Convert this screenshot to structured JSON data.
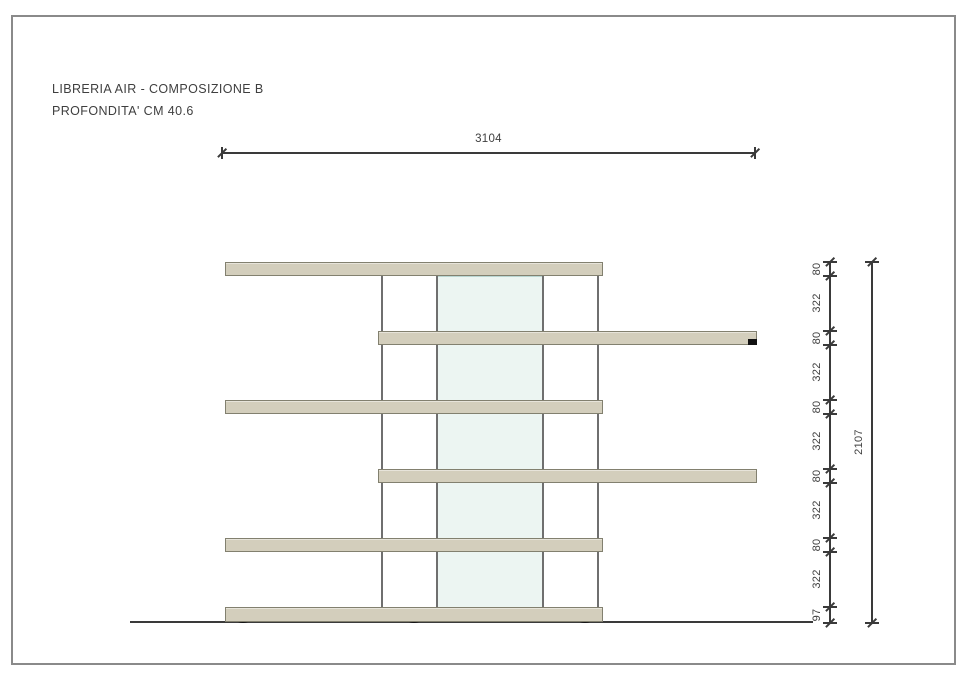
{
  "title": {
    "line1": "LIBRERIA AIR - COMPOSIZIONE B",
    "line2": "PROFONDITA' CM 40.6"
  },
  "dimensions": {
    "total_width": "3104",
    "total_height": "2107",
    "height_segments": [
      "80",
      "322",
      "80",
      "322",
      "80",
      "322",
      "80",
      "322",
      "80",
      "322",
      "97"
    ]
  },
  "colors": {
    "shelf-fill": "#d3cebc",
    "shelf-border": "#82806f",
    "panel-fill": "#ecf5f2",
    "panel-border": "#b9d6d2",
    "rod-color": "#6f6f6f",
    "line-color": "#3a3a3a",
    "text-color": "#3f3f3f",
    "frame-color": "#8a8a8a"
  }
}
